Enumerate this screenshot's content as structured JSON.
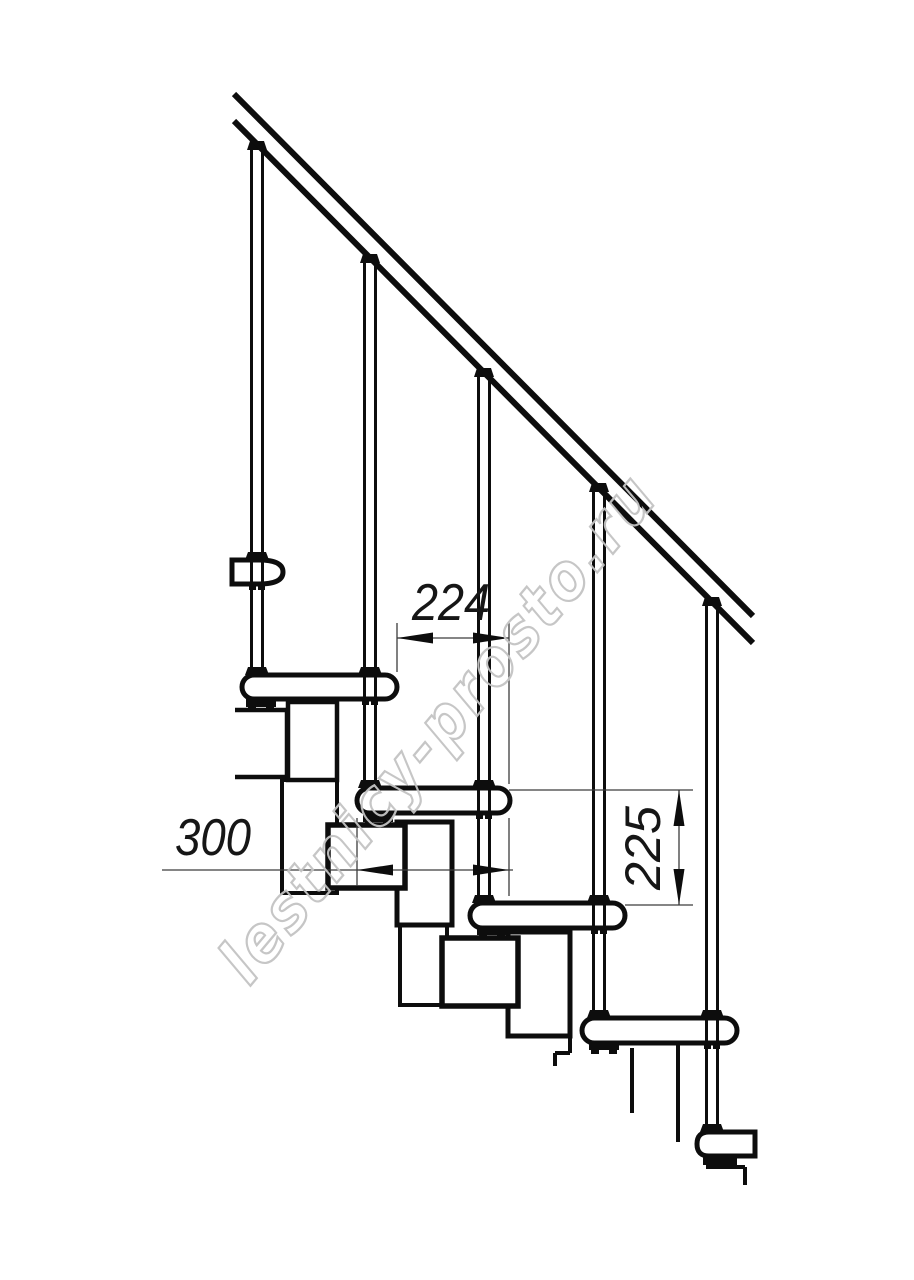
{
  "figure": {
    "kind": "technical-drawing",
    "subject": "modular staircase side elevation with handrail",
    "counts": {
      "treads_visible": 6,
      "balusters": 5
    }
  },
  "dimensions": {
    "run": {
      "value": "224",
      "orientation": "horizontal"
    },
    "tread_depth": {
      "value": "300",
      "orientation": "horizontal"
    },
    "rise": {
      "value": "225",
      "orientation": "vertical"
    }
  },
  "watermark": {
    "text": "lestnicy-prosto.ru"
  },
  "colors": {
    "background": "#ffffff",
    "line": "#0d0d0d",
    "dimension_line": "#3c3c3c",
    "watermark": "#c3c3c3"
  }
}
